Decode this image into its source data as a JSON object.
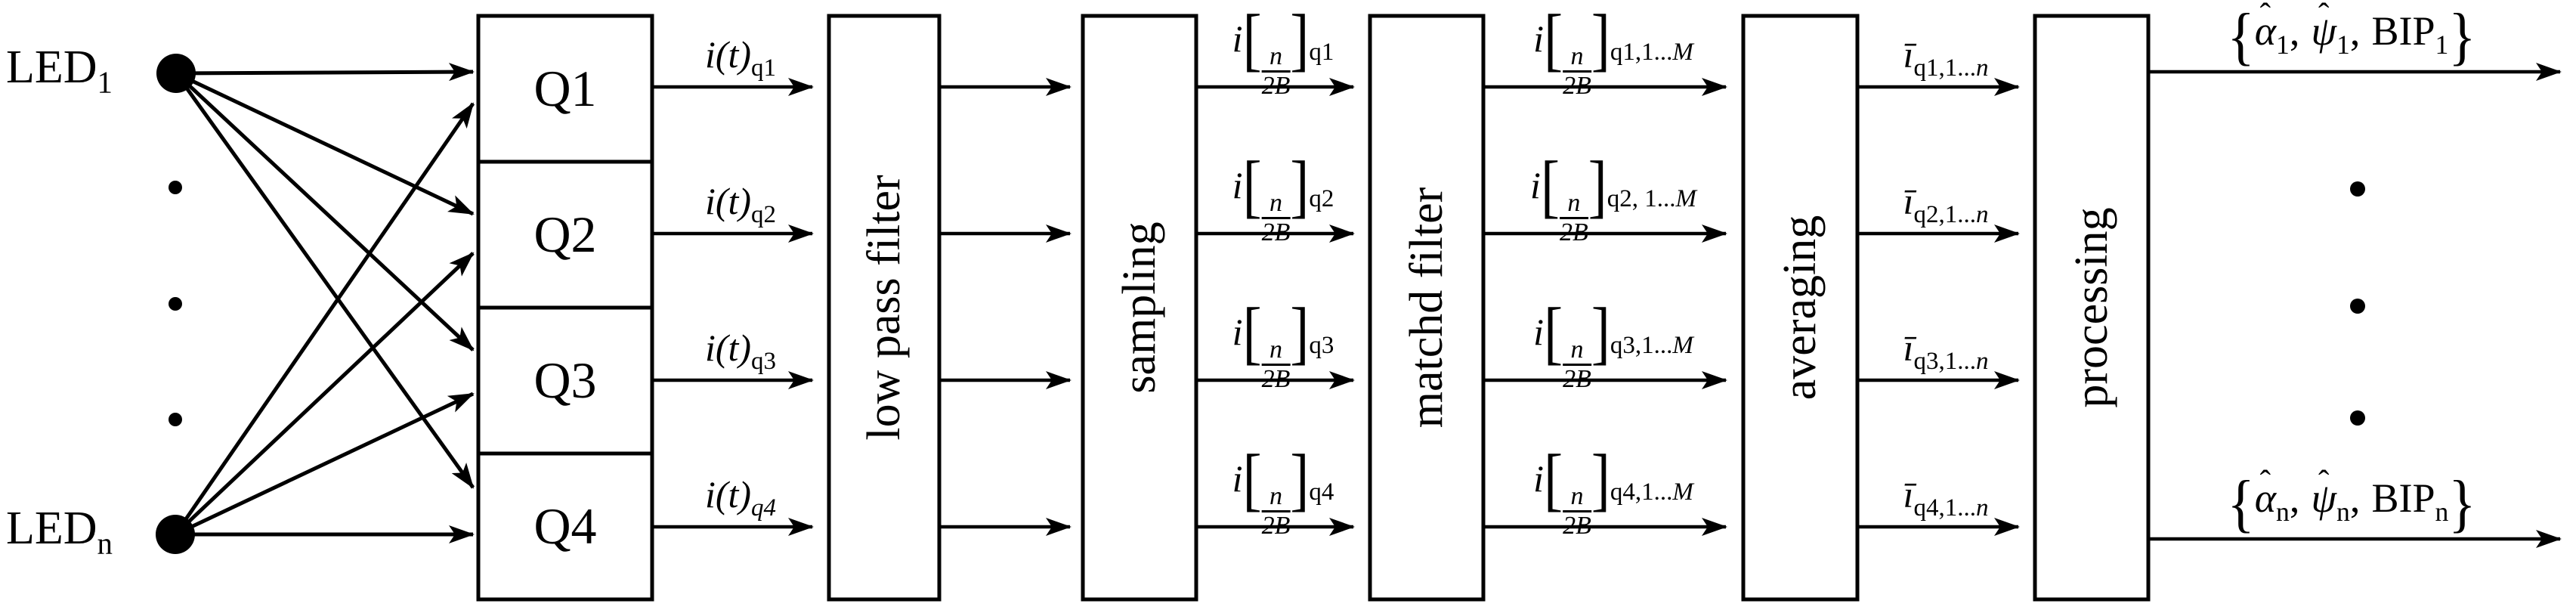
{
  "leds": {
    "name": "LED",
    "sub_top": "1",
    "sub_bottom": "n"
  },
  "quadrants": [
    {
      "label": "Q1"
    },
    {
      "label": "Q2"
    },
    {
      "label": "Q3"
    },
    {
      "label": "Q4"
    }
  ],
  "blocks": [
    {
      "label": "low pass filter"
    },
    {
      "label": "sampling"
    },
    {
      "label": "matchd filter"
    },
    {
      "label": "averaging"
    },
    {
      "label": "processing"
    }
  ],
  "symbols": {
    "hat": "ˆ",
    "alpha": "α",
    "psi": "ψ",
    "bip": "BIP",
    "lbrace": "{",
    "rbrace": "}",
    "lbracket": "[",
    "rbracket": "]",
    "comma": ","
  },
  "stage1": [
    {
      "main": "i(t)",
      "sub_plain": "q1",
      "sub_italic": ""
    },
    {
      "main": "i(t)",
      "sub_plain": "q2",
      "sub_italic": ""
    },
    {
      "main": "i(t)",
      "sub_plain": "q3",
      "sub_italic": ""
    },
    {
      "main": "i(t)",
      "sub_plain": "",
      "sub_italic": "q4"
    }
  ],
  "stage2": [
    {
      "pre": "i",
      "top": "n",
      "bot": "2B",
      "sub_plain": "q1",
      "sub_italic": ""
    },
    {
      "pre": "i",
      "top": "n",
      "bot": "2B",
      "sub_plain": "q2",
      "sub_italic": ""
    },
    {
      "pre": "i",
      "top": "n",
      "bot": "2B",
      "sub_plain": "q3",
      "sub_italic": ""
    },
    {
      "pre": "i",
      "top": "n",
      "bot": "2B",
      "sub_plain": "q4",
      "sub_italic": ""
    }
  ],
  "stage3": [
    {
      "pre": "i",
      "top": "n",
      "bot": "2B",
      "sub_plain": "q1,1...",
      "sub_italic": "M"
    },
    {
      "pre": "i",
      "top": "n",
      "bot": "2B",
      "sub_plain": "q2, 1...",
      "sub_italic": "M"
    },
    {
      "pre": "i",
      "top": "n",
      "bot": "2B",
      "sub_plain": "q3,1...",
      "sub_italic": "M"
    },
    {
      "pre": "i",
      "top": "n",
      "bot": "2B",
      "sub_plain": "q4,1...",
      "sub_italic": "M"
    }
  ],
  "stage4": [
    {
      "main": "ī",
      "sub_plain": "q1,1...",
      "sub_italic": "n"
    },
    {
      "main": "ī",
      "sub_plain": "q2,1...",
      "sub_italic": "n"
    },
    {
      "main": "ī",
      "sub_plain": "q3,1...",
      "sub_italic": "n"
    },
    {
      "main": "ī",
      "sub_plain": "q4,1...",
      "sub_italic": "n"
    }
  ],
  "outputs": [
    {
      "alpha_sub": "1",
      "psi_sub": "1",
      "bip_sub": "1"
    },
    {
      "alpha_sub": "n",
      "psi_sub": "n",
      "bip_sub": "n"
    }
  ]
}
